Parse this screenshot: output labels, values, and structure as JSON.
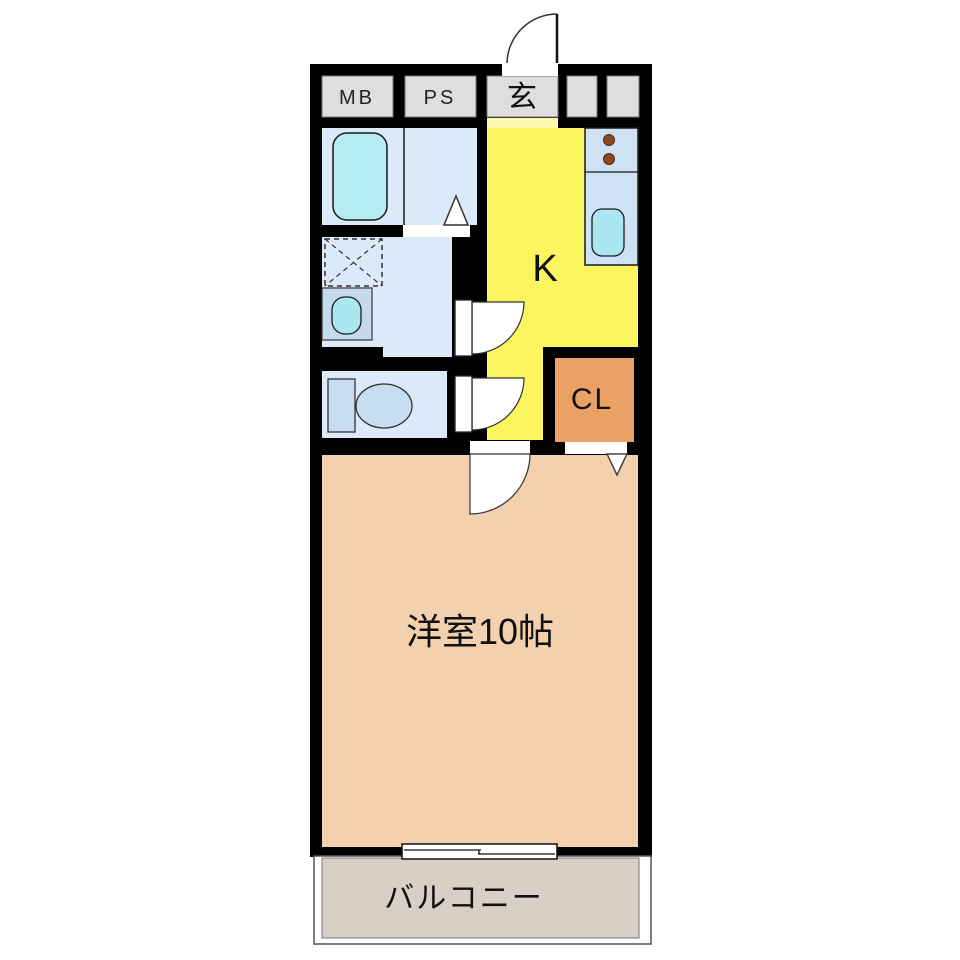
{
  "plan": {
    "labels": {
      "meter_box": "MB",
      "pipe_space": "PS",
      "entrance": "玄",
      "kitchen": "K",
      "closet": "CL",
      "main_room": "洋室10帖",
      "balcony": "バルコニー"
    },
    "colors": {
      "wall": "#000000",
      "utility_box": "#dedede",
      "wet_floor": "#dce9f8",
      "bathtub": "#b6edf3",
      "fixture_blue": "#c9ddf2",
      "washbasin_box": "#c6daef",
      "basin": "#abe7f0",
      "kitchen": "#fbf55f",
      "genkan_step": "#fbf8ae",
      "counter": "#cfe2f5",
      "burner": "#8b4a1e",
      "sink": "#abe7f0",
      "closet": "#e9a263",
      "main_room": "#f3d1ae",
      "balcony": "#d8cfc5",
      "door_white": "#ffffff"
    }
  }
}
